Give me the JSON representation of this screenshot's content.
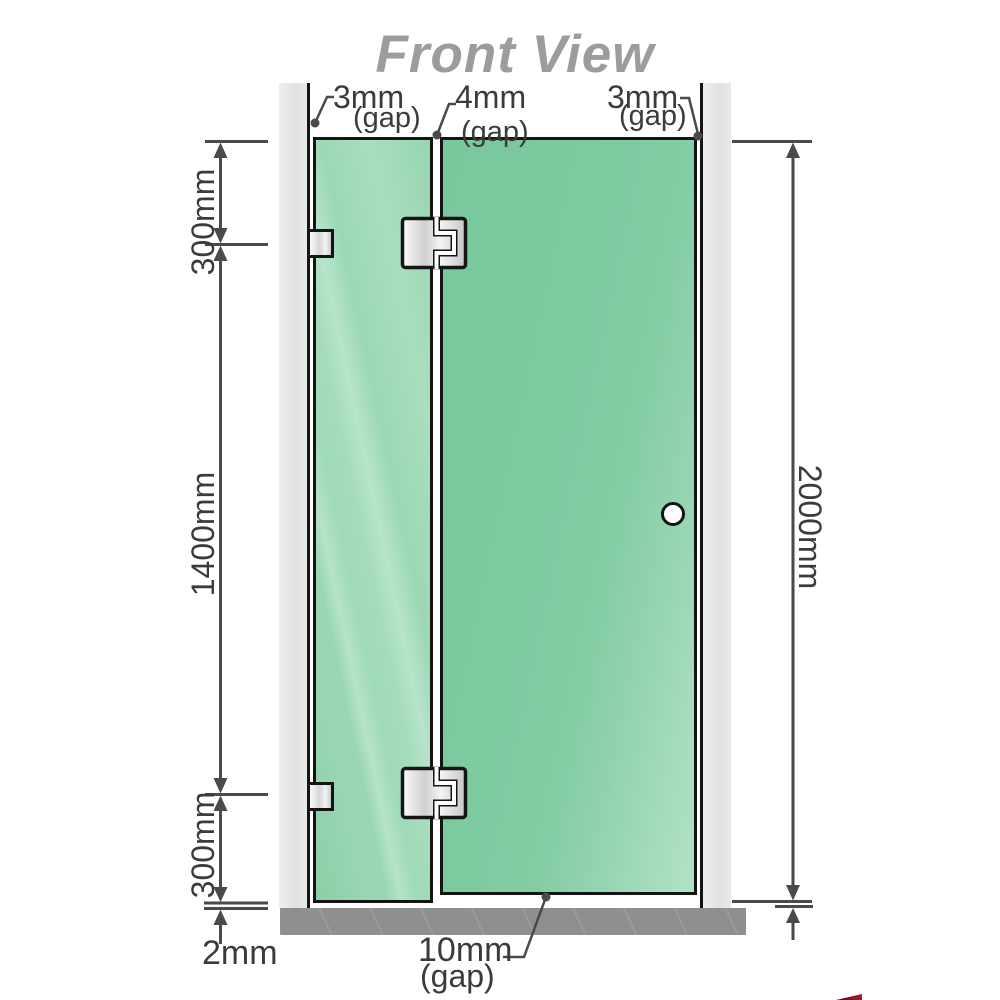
{
  "title": "Front View",
  "top_gaps": [
    {
      "value": "3mm",
      "suffix": "(gap)"
    },
    {
      "value": "4mm",
      "suffix": "(gap)"
    },
    {
      "value": "3mm",
      "suffix": "(gap)"
    }
  ],
  "left_dimensions": {
    "top": "300mm",
    "middle": "1400mm",
    "bottom": "300mm",
    "floor_gap": "2mm"
  },
  "right_dimension": "2000mm",
  "bottom_gap": {
    "value": "10mm",
    "suffix": "(gap)"
  },
  "colors": {
    "glass_green": "#8ad0a8",
    "glass_highlight": "#b5e3c9",
    "frame_black": "#141414",
    "wall_channel_gray": "#e6e6e6",
    "floor_gray": "#8f8f8f",
    "dimension_gray": "#4a4a4a",
    "title_gray": "#9c9c9c"
  }
}
